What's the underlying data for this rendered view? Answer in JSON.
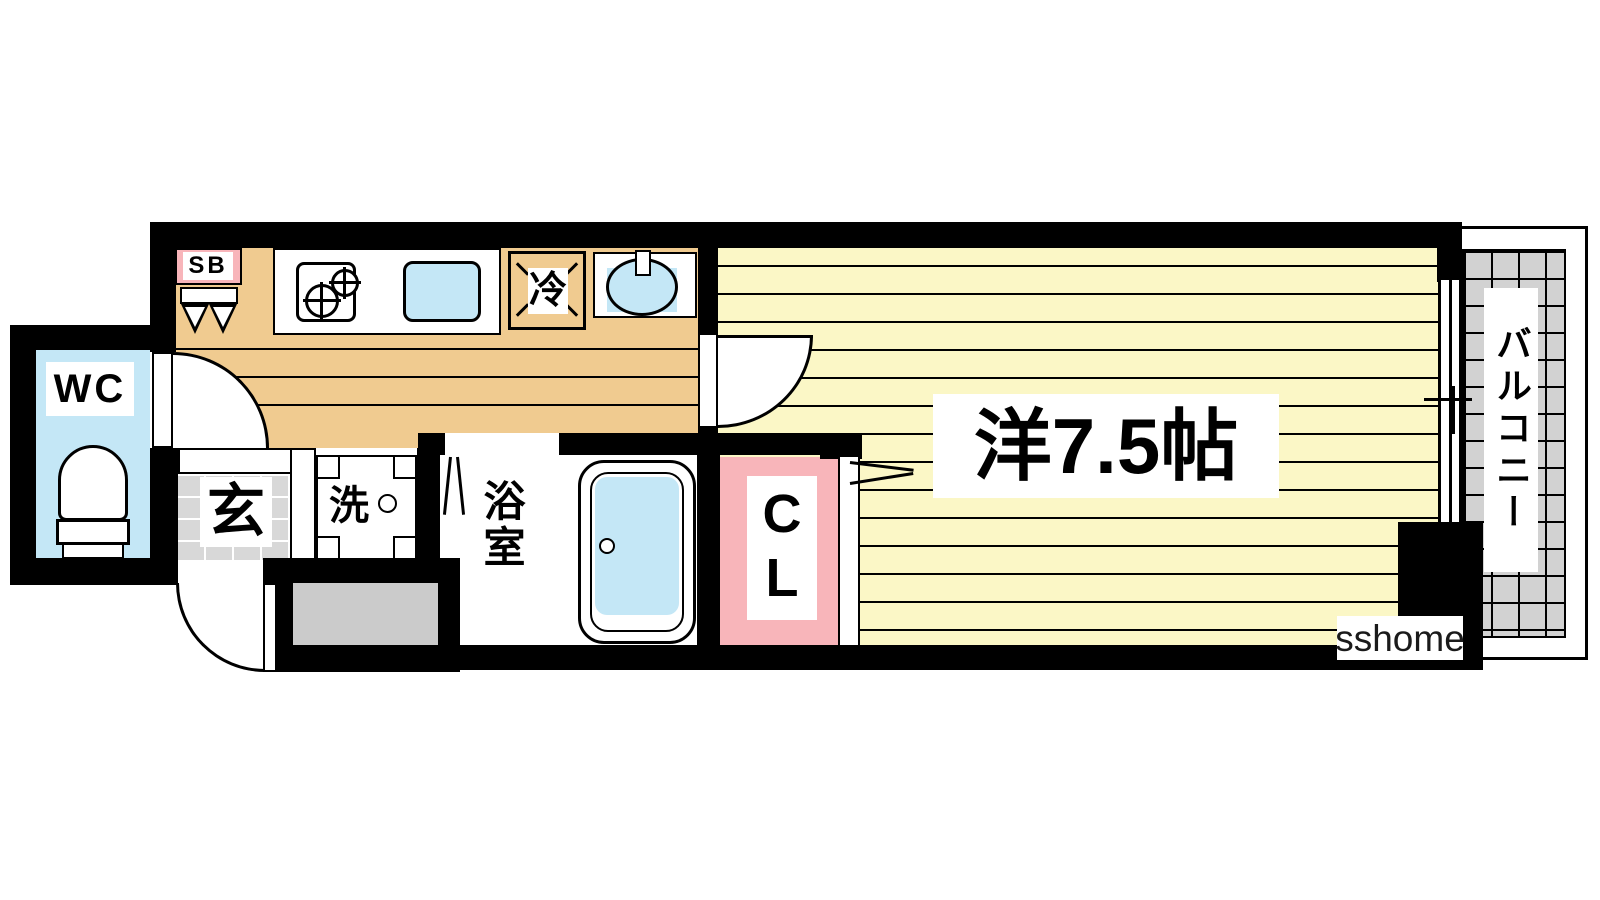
{
  "watermark": "sshome",
  "rooms": {
    "toilet": {
      "label": "WC"
    },
    "shoe_box": {
      "label": "SB"
    },
    "refrigerator": {
      "label": "冷"
    },
    "laundry": {
      "label": "洗"
    },
    "entrance": {
      "label": "玄"
    },
    "bathroom": {
      "label": "浴室"
    },
    "closet": {
      "label": "CL"
    },
    "western_room": {
      "label": "洋7.5帖",
      "size_jo": 7.5
    },
    "balcony": {
      "label": "バルコニー"
    }
  },
  "fixtures": {
    "stove": "two-burner-stove-icon",
    "kitchen_sink": "kitchen-sink-icon",
    "wash_basin": "wash-basin-icon",
    "bathtub": "bathtub-icon",
    "toilet": "toilet-icon",
    "washer_pan": "washing-machine-pan-icon",
    "shoe_box": "shoe-box-icon",
    "window": "sliding-window-icon"
  },
  "colors": {
    "wall": "#000000",
    "hall_floor": "#F0CB90",
    "room_floor": "#FBF7C6",
    "water_blue": "#C4E7F6",
    "accent_pink": "#F8B5BA",
    "tile_gray": "#D8D8D8",
    "balcony_gray": "#D2D2D2",
    "utility_gray": "#CBCBCB"
  }
}
